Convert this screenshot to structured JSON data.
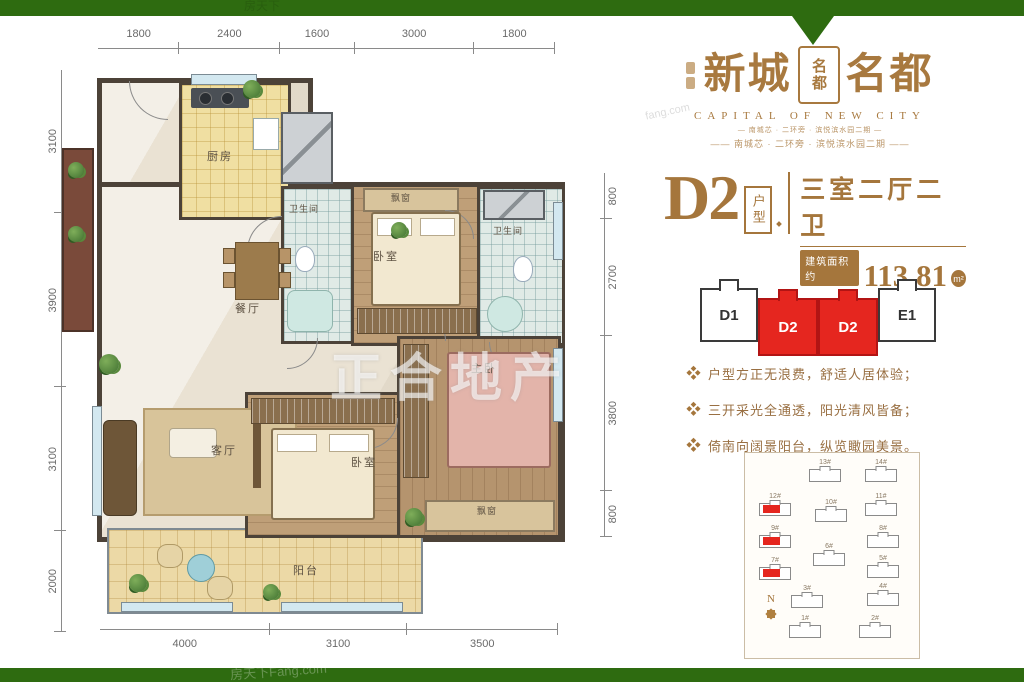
{
  "colors": {
    "green": "#2e6b10",
    "brown": "#a5763c",
    "red": "#e5261f"
  },
  "watermarks": {
    "center": "正合地产",
    "top_left": "房天下",
    "bottom": "房天下Fang.com",
    "logo_corner": "fang.com"
  },
  "floor_plan": {
    "dims": {
      "top": [
        1800,
        2400,
        1600,
        3000,
        1800
      ],
      "left": [
        3100,
        3900,
        3100,
        2000
      ],
      "right": [
        800,
        2700,
        3800,
        800
      ],
      "bottom": [
        4000,
        3100,
        3500
      ]
    },
    "rooms": {
      "kitchen": "厨房",
      "bath1": "卫生间",
      "bedroom_top": "卧室",
      "bay_top": "飘窗",
      "bath2": "卫生间",
      "dining": "餐厅",
      "living": "客厅",
      "bedroom_mid": "卧室",
      "master": "主卧",
      "bay_bottom": "飘窗",
      "balcony": "阳台"
    }
  },
  "brand": {
    "name_left": "新城",
    "name_right": "名都",
    "seal_text": "名都",
    "subtitle": "CAPITAL OF NEW CITY",
    "tagline_1": "— 南城芯 · 二环旁 · 滨悦滨水园二期 —",
    "tagline_2": "—— 南城芯 · 二环旁 · 滨悦滨水园二期 ——"
  },
  "unit": {
    "code": "D2",
    "code_suffix": "户型",
    "layout": "三室二厅二卫",
    "area_label": "建筑面积约",
    "area_value": "113.81",
    "area_unit": "m²",
    "slogan": "完美的一天，应该是被阳光叫醒的"
  },
  "strip_units": [
    {
      "label": "D1",
      "highlight": false
    },
    {
      "label": "D2",
      "highlight": true
    },
    {
      "label": "D2",
      "highlight": true
    },
    {
      "label": "E1",
      "highlight": false
    }
  ],
  "features": [
    "户型方正无浪费，舒适人居体验；",
    "三开采光全通透，阳光清风皆备；",
    "倚南向阔景阳台，纵览瞰园美景。"
  ],
  "site_plan": {
    "compass": "N",
    "buildings": [
      {
        "no": "13#",
        "x": 64,
        "y": 16,
        "hl": false
      },
      {
        "no": "14#",
        "x": 120,
        "y": 16,
        "hl": false
      },
      {
        "no": "12#",
        "x": 14,
        "y": 50,
        "hl": true
      },
      {
        "no": "10#",
        "x": 70,
        "y": 56,
        "hl": false
      },
      {
        "no": "11#",
        "x": 120,
        "y": 50,
        "hl": false
      },
      {
        "no": "9#",
        "x": 14,
        "y": 82,
        "hl": true
      },
      {
        "no": "8#",
        "x": 122,
        "y": 82,
        "hl": false
      },
      {
        "no": "7#",
        "x": 14,
        "y": 114,
        "hl": true
      },
      {
        "no": "6#",
        "x": 68,
        "y": 100,
        "hl": false
      },
      {
        "no": "5#",
        "x": 122,
        "y": 112,
        "hl": false
      },
      {
        "no": "3#",
        "x": 46,
        "y": 142,
        "hl": false
      },
      {
        "no": "4#",
        "x": 122,
        "y": 140,
        "hl": false
      },
      {
        "no": "1#",
        "x": 44,
        "y": 172,
        "hl": false
      },
      {
        "no": "2#",
        "x": 114,
        "y": 172,
        "hl": false
      }
    ]
  }
}
